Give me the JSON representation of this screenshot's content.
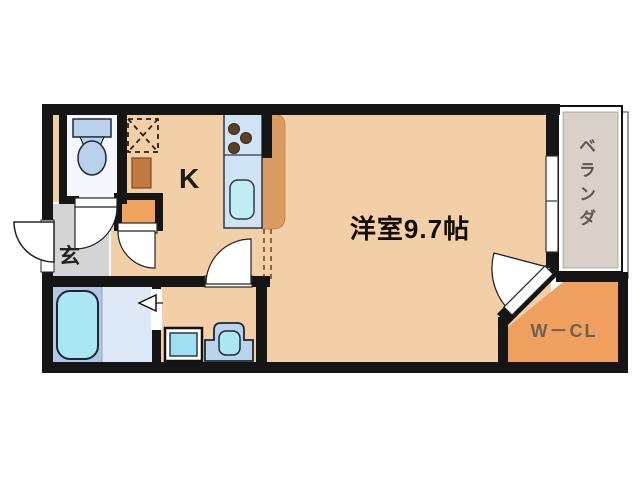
{
  "floor_plan": {
    "title": "1K apartment floor plan",
    "labels": {
      "kitchen": "K",
      "main_room": "洋室9.7帖",
      "entrance": "玄",
      "walk_in_closet": "W－CL",
      "veranda": "ベランダ"
    },
    "rooms": [
      {
        "name": "kitchen",
        "label": "K"
      },
      {
        "name": "western-room",
        "label": "洋室9.7帖",
        "size_jyo": 9.7
      },
      {
        "name": "entrance-genkan",
        "label": "玄"
      },
      {
        "name": "walk-in-closet",
        "label": "W－CL"
      },
      {
        "name": "veranda",
        "label": "ベランダ"
      },
      {
        "name": "toilet-room"
      },
      {
        "name": "bathroom"
      },
      {
        "name": "washroom"
      }
    ],
    "colors": {
      "wall": "#151515",
      "floor_main": "#f3cfa8",
      "entrance_floor": "#d4d4d4",
      "closet_orange": "#efa05e",
      "counter_orange": "#dc9b63",
      "veranda_gray": "#d7d1c8",
      "bath_blue": "#b2c7e5",
      "bath_floor_light": "#dde9f6",
      "fixture_blue": "#bcd3ee",
      "water_cyan": "#a9e7f2",
      "toilet_floor": "#f4f7fd",
      "storage_brown": "#c1793f"
    }
  }
}
